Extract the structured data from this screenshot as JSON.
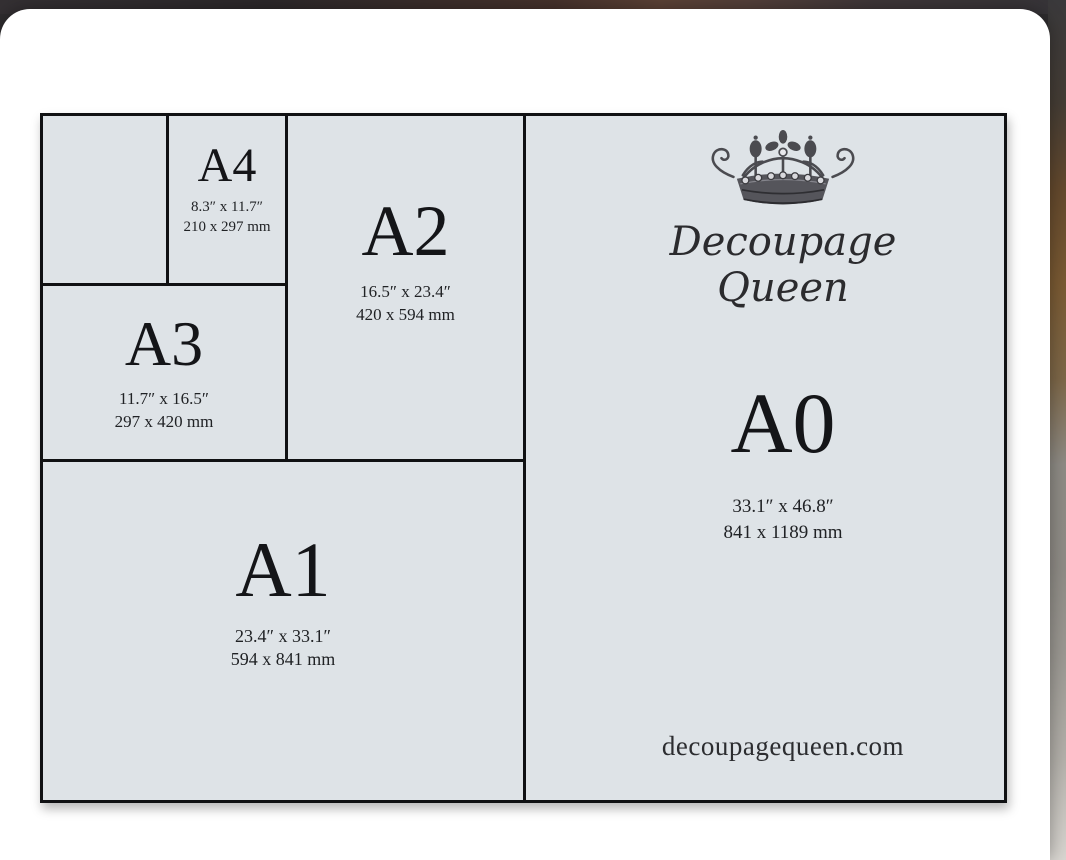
{
  "colors": {
    "chart_background": "#dee3e7",
    "chart_line": "#101113",
    "card_background": "#ffffff"
  },
  "chart": {
    "cells": {
      "a4": {
        "label": "A4",
        "inches": "8.3″ x 11.7″",
        "mm": "210 x 297 mm"
      },
      "a3": {
        "label": "A3",
        "inches": "11.7″ x 16.5″",
        "mm": "297 x 420 mm"
      },
      "a2": {
        "label": "A2",
        "inches": "16.5″ x 23.4″",
        "mm": "420 x 594 mm"
      },
      "a1": {
        "label": "A1",
        "inches": "23.4″ x 33.1″",
        "mm": "594 x 841 mm"
      },
      "a0": {
        "label": "A0",
        "inches": "33.1″ x 46.8″",
        "mm": "841 x 1189 mm"
      }
    },
    "brand": {
      "name_line1": "Decoupage",
      "name_line2": "Queen",
      "website": "decoupagequeen.com",
      "logo": "crown-icon"
    }
  }
}
